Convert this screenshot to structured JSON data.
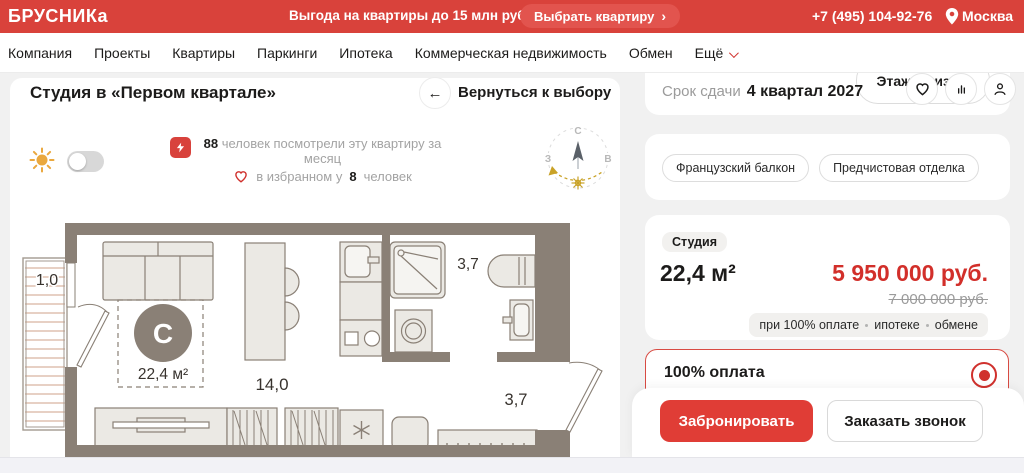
{
  "topbar": {
    "logo": "БРУСНИКа",
    "promo": "Выгода на квартиры до 15 млн руб.",
    "cta_label": "Выбрать квартиру",
    "cta_arrow": "›",
    "phone": "+7 (495) 104-92-76",
    "city": "Москва"
  },
  "nav": {
    "items": [
      "Компания",
      "Проекты",
      "Квартиры",
      "Паркинги",
      "Ипотека",
      "Коммерческая недвижимость",
      "Обмен",
      "Ещё"
    ]
  },
  "page": {
    "title": "Студия в «Первом квартале»",
    "back_label": "Вернуться к выбору"
  },
  "stats": {
    "views_count": "88",
    "views_line1": " человек посмотрели эту квартиру за",
    "views_line2": "месяц",
    "fav_prefix": "в избранном у",
    "fav_count": "8",
    "fav_suffix": "человек"
  },
  "plan": {
    "balcony_area": "1,0",
    "bath_area": "3,7",
    "hall_area": "3,7",
    "room_area": "14,0",
    "total_area": "22,4 м²",
    "center_letter": "С"
  },
  "compass": {
    "north": "С",
    "west": "З",
    "east": "В"
  },
  "panel": {
    "deadline_label": "Срок сдачи",
    "deadline_value": "4 квартал 2027",
    "floor_badge": "Этаж 10 из 17",
    "tags": [
      "Французский балкон",
      "Предчистовая отделка"
    ],
    "type_badge": "Студия",
    "area": "22,4 м²",
    "price": "5 950 000 руб.",
    "old_price": "7 000 000 руб.",
    "payment_parts": [
      "при 100% оплате",
      "ипотеке",
      "обмене"
    ],
    "payment_option": "100% оплата",
    "book_label": "Забронировать",
    "call_label": "Заказать звонок"
  },
  "colors": {
    "brand_red": "#d9423b",
    "price_red": "#d22f2a",
    "wall_taupe": "#8a8076",
    "gold": "#c9a227"
  }
}
